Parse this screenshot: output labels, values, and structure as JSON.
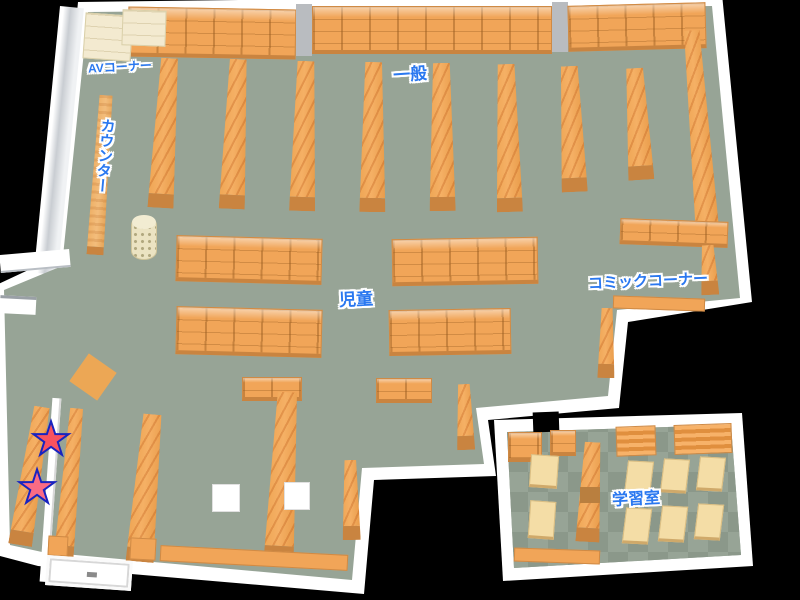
{
  "areas": {
    "av_corner": {
      "label": "AVコーナー"
    },
    "general": {
      "label": "一般"
    },
    "counter": {
      "label": "カウンター"
    },
    "children": {
      "label": "児童"
    },
    "comic_corner": {
      "label": "コミックコーナー"
    },
    "study_room": {
      "label": "学習室"
    }
  },
  "markers": {
    "star1": {
      "icon": "star-icon",
      "glyph": "★",
      "fill": "#f8525f",
      "outline": "#1823c0"
    },
    "star2": {
      "icon": "star-icon",
      "glyph": "★",
      "fill": "#fa6b84",
      "outline": "#1823c0"
    }
  },
  "theme": {
    "background": "#000000",
    "wall": "#ffffff",
    "wall_shade": "#c9cdd2",
    "floor_light": "#97a496",
    "floor_dark": "#8b988a",
    "shelf": "#f1a558",
    "shelf_dark": "#c98440",
    "counter": "#ecae63",
    "av_shelf": "#f3ead0",
    "table": "#f4dda6",
    "pillar": "#b9bcc0",
    "label_color": "#2a78f0"
  }
}
